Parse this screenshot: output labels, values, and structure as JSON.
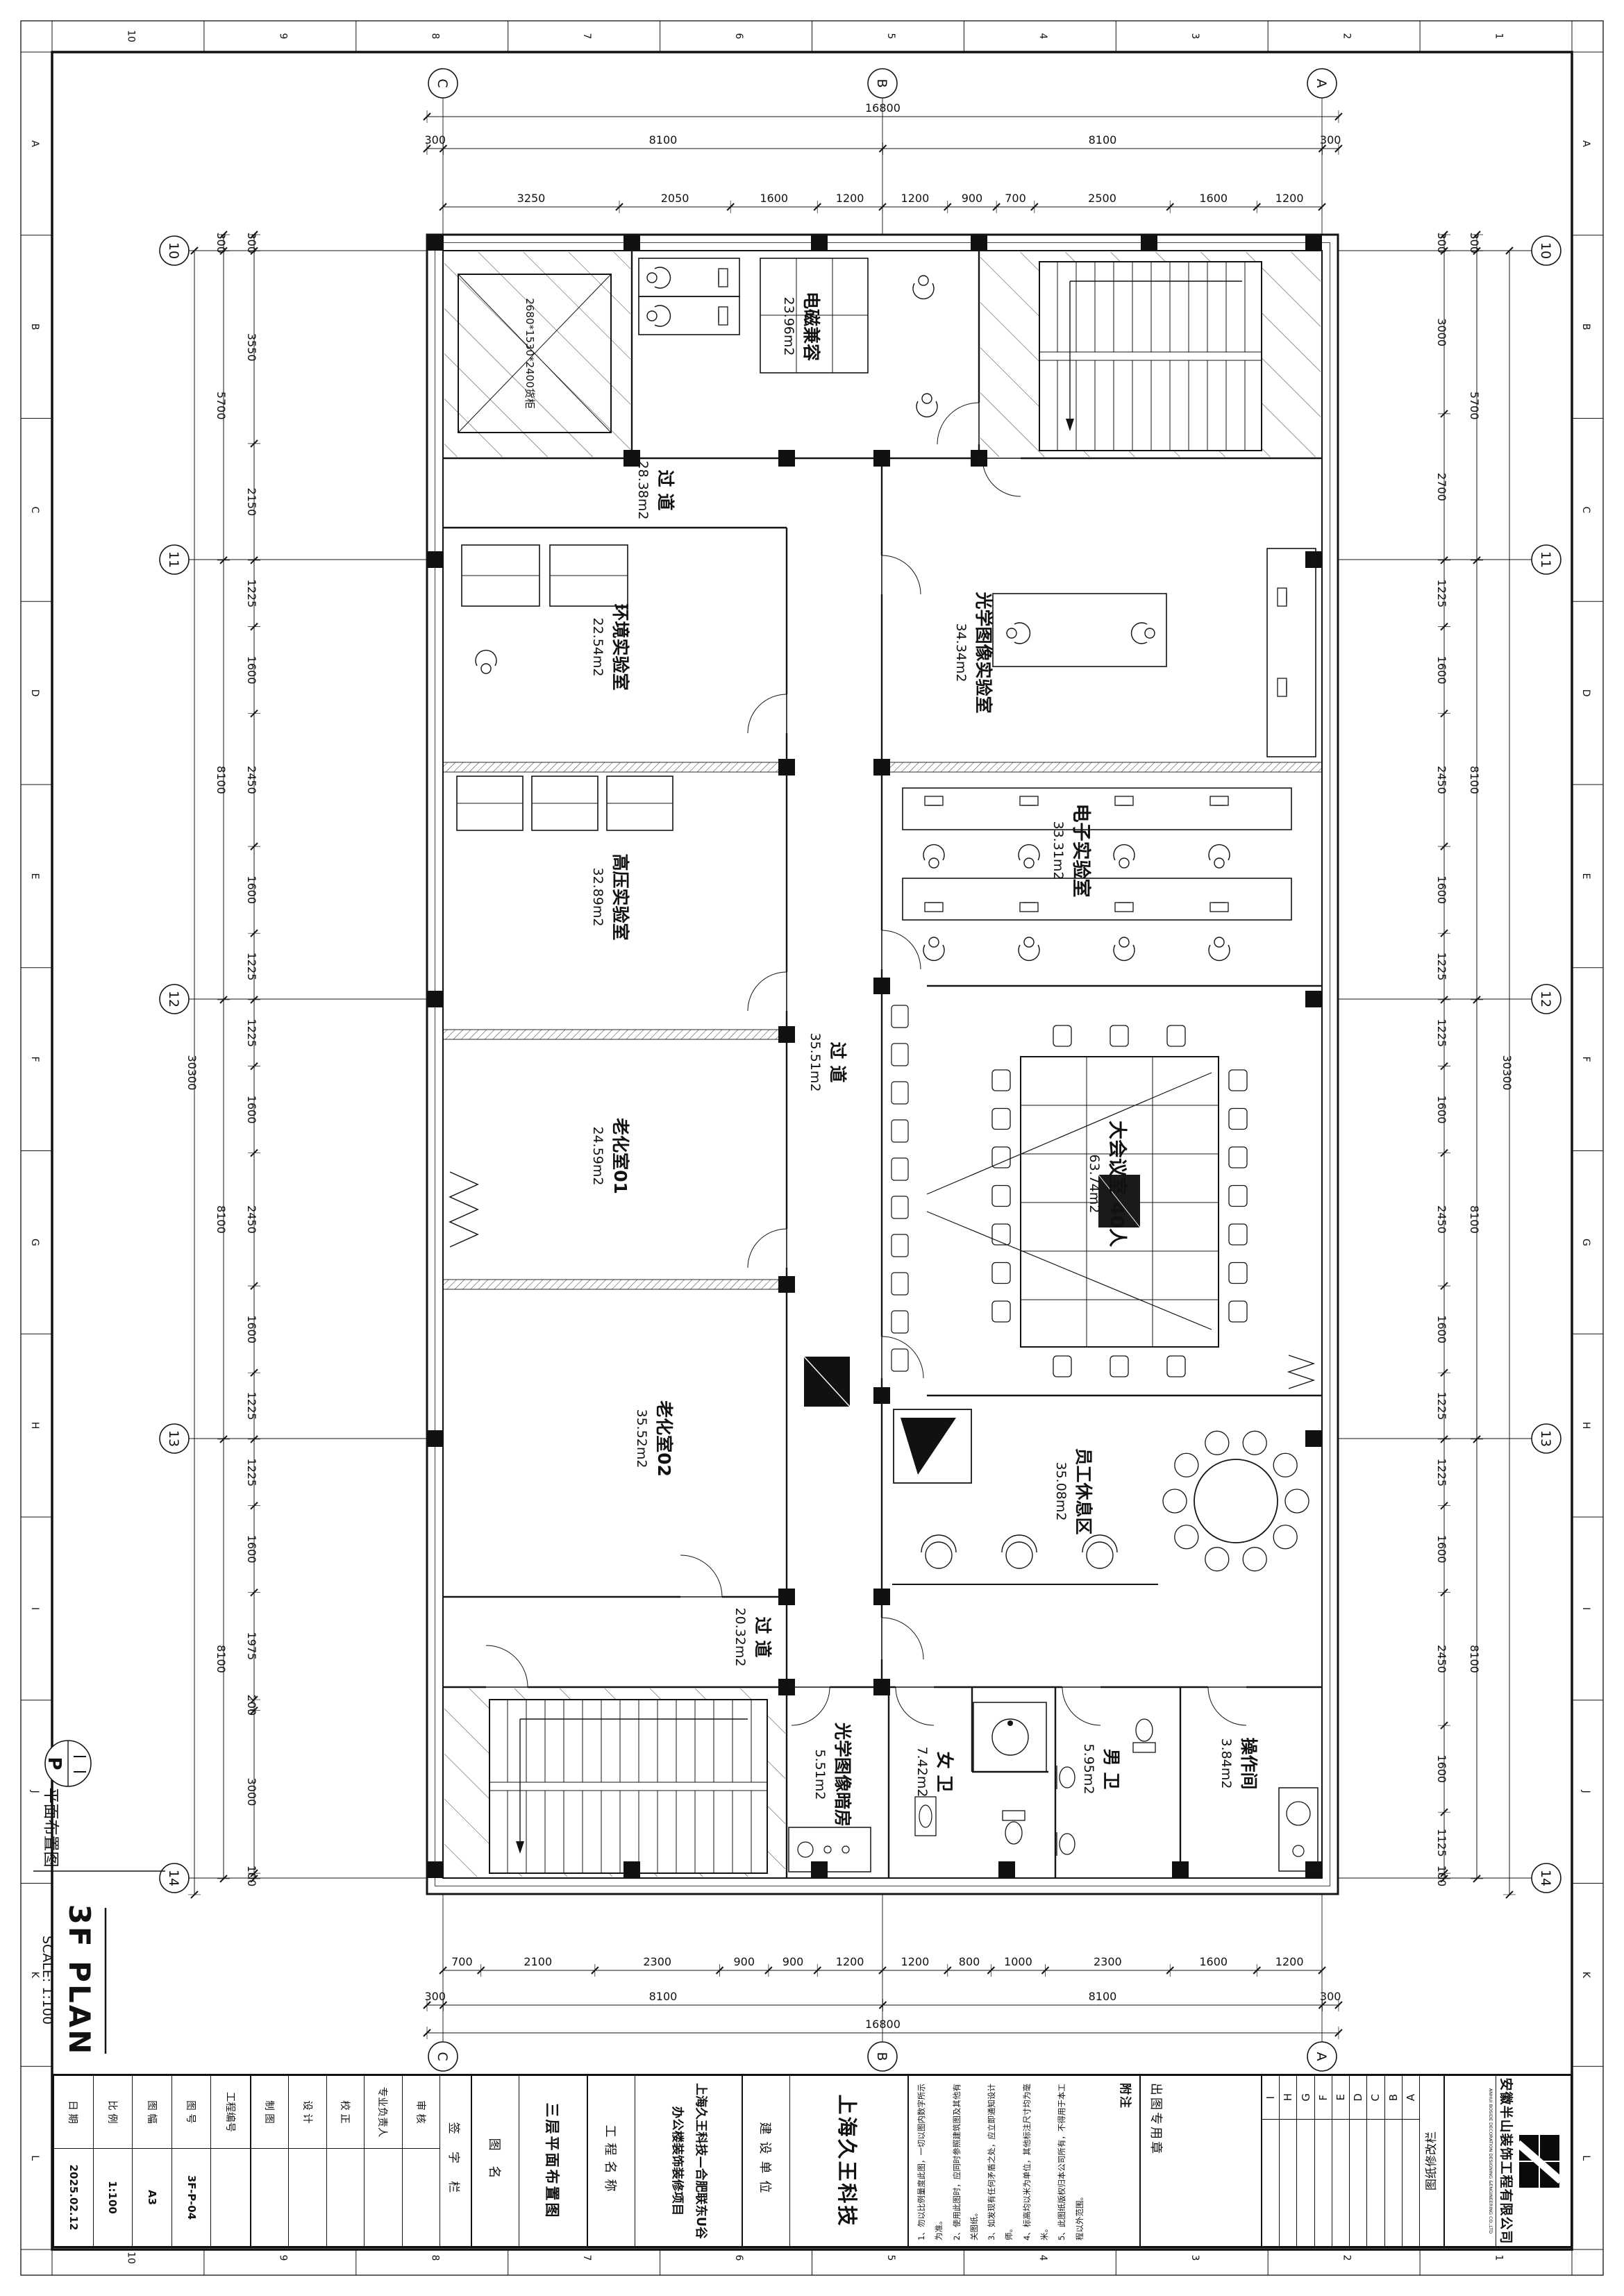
{
  "sheet": {
    "zone_numbers": [
      "10",
      "9",
      "8",
      "7",
      "6",
      "5",
      "4",
      "3",
      "2",
      "1"
    ],
    "zone_letters": [
      "A",
      "B",
      "C",
      "D",
      "E",
      "F",
      "G",
      "H",
      "I",
      "J",
      "K",
      "L"
    ]
  },
  "plan": {
    "grid_cols": [
      "C",
      "B",
      "A"
    ],
    "grid_rows": [
      "10",
      "11",
      "12",
      "13",
      "14"
    ],
    "dims": {
      "top_overall": "16800",
      "top_axis": [
        "300",
        "8100",
        "8100",
        "300"
      ],
      "top_detail": [
        "3250",
        "2050",
        "1600",
        "1200",
        "1200",
        "900",
        "700",
        "2500",
        "1600",
        "1200"
      ],
      "bottom_overall": "16800",
      "bottom_axis": [
        "300",
        "8100",
        "8100",
        "300"
      ],
      "bottom_detail": [
        "700",
        "2100",
        "2300",
        "900",
        "900",
        "1200",
        "1200",
        "800",
        "1000",
        "2300",
        "1600",
        "1200"
      ],
      "left_overall": "30300",
      "left_axis": [
        "300",
        "5700",
        "8100",
        "8100",
        "8100"
      ],
      "left_detail": [
        "300",
        "3550",
        "2150",
        "1225",
        "1600",
        "2450",
        "1600",
        "1225",
        "1225",
        "1600",
        "2450",
        "1600",
        "1225",
        "1225",
        "1600",
        "1975",
        "200",
        "3000",
        "100"
      ],
      "right_overall": "30300",
      "right_axis": [
        "300",
        "5700",
        "8100",
        "8100",
        "8100"
      ],
      "right_detail": [
        "300",
        "3000",
        "2700",
        "1225",
        "1600",
        "2450",
        "1600",
        "1225",
        "1225",
        "1600",
        "2450",
        "1600",
        "1225",
        "1225",
        "1600",
        "2450",
        "1600",
        "1125",
        "100"
      ]
    },
    "rooms": {
      "emc": {
        "name": "电磁兼容",
        "area": "23.96m2"
      },
      "corridor_top": {
        "name": "过 道",
        "area": "28.38m2"
      },
      "env": {
        "name": "环境实验室",
        "area": "22.54m2"
      },
      "hv": {
        "name": "高压实验室",
        "area": "32.89m2"
      },
      "aging1": {
        "name": "老化室01",
        "area": "24.59m2"
      },
      "aging2": {
        "name": "老化室02",
        "area": "35.52m2"
      },
      "corridor_mid": {
        "name": "过 道",
        "area": "35.51m2"
      },
      "optical": {
        "name": "光学图像实验室",
        "area": "34.34m2"
      },
      "elec": {
        "name": "电子实验室",
        "area": "33.31m2"
      },
      "meeting": {
        "name": "大会议室 40人",
        "area": "63.74m2"
      },
      "rest": {
        "name": "员工休息区",
        "area": "35.08m2"
      },
      "corridor_bottom": {
        "name": "过 道",
        "area": "20.32m2"
      },
      "darkroom": {
        "name": "光学图像暗房",
        "area": "5.51m2"
      },
      "wc_f": {
        "name": "女 卫",
        "area": "7.42m2"
      },
      "wc_m": {
        "name": "男 卫",
        "area": "5.95m2"
      },
      "op": {
        "name": "操作间",
        "area": "3.84m2"
      }
    },
    "equipment_label": "2680*1530*2400货柜",
    "legend": {
      "symbol": "P",
      "label": "平面布置图",
      "title": "3F PLAN",
      "scale": "SCALE: 1:100"
    }
  },
  "titleblock": {
    "company_cn": "安徽半山装饰工程有限公司",
    "company_en": "ANHUI BOSIDE DECORATION DESIGNING &ENGINEERING CO.,LTD",
    "revision_title": "图纸修改栏",
    "revision_rows": [
      "A",
      "B",
      "C",
      "D",
      "E",
      "F",
      "G",
      "H",
      "I"
    ],
    "seal_label": "出图专用章",
    "notes_title": "附注",
    "notes": [
      "1、勿以比例量度此图，一切以图内数字所示为准。",
      "2、使用此图时，应同时参照建筑图及其他有关图纸。",
      "3、如发现有任何矛盾之处，应立即通知设计师。",
      "4、标高均以米为单位，其他标注尺寸均为毫米。",
      "5、此图纸版权归本公司所有，不得用于本工程以外范围。"
    ],
    "owner_label": "建设单位",
    "owner_value": "上海久王科技",
    "project_label": "工程名称",
    "project_line1": "上海久王科技—合肥联东U谷",
    "project_line2": "办公楼装饰装修项目",
    "dwgname_label": "图  名",
    "dwgname_value": "三层平面布置图",
    "sign_header": "签 字 栏",
    "sign_rows": [
      "审 核",
      "专业负责人",
      "校 正",
      "设 计",
      "制 图"
    ],
    "num_rows": [
      {
        "label": "工程编号",
        "value": ""
      },
      {
        "label": "图  号",
        "value": "3F-P-04"
      },
      {
        "label": "图  幅",
        "value": "A3"
      },
      {
        "label": "比  例",
        "value": "1:100"
      },
      {
        "label": "日  期",
        "value": "2025.02.12"
      }
    ]
  }
}
